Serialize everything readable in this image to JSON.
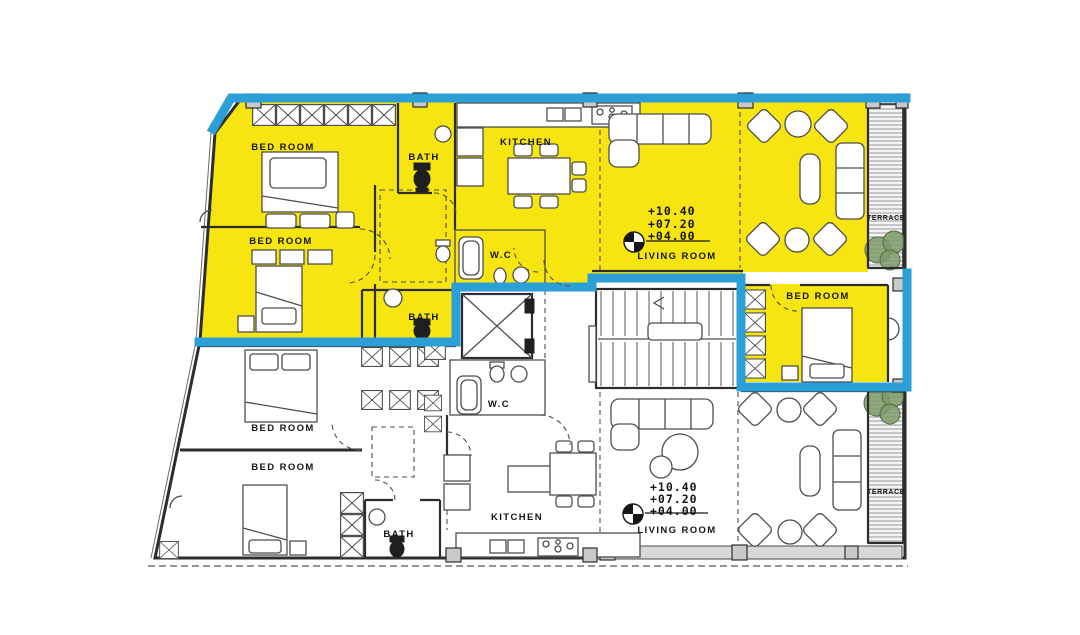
{
  "colors": {
    "highlight": "#F7E511",
    "outline": "#2B9FD6",
    "wall": "#2D2D2D",
    "line": "#4E4E4E",
    "plant": "#7D9A68",
    "hatch": "#8C8C8C",
    "slab": "#D8D8D8",
    "column": "#C9C9C9"
  },
  "upper_unit": {
    "rooms": {
      "bedroom_1": "BED ROOM",
      "bedroom_2": "BED ROOM",
      "bedroom_3": "BED ROOM",
      "bath_1": "BATH",
      "bath_2": "BATH",
      "wc": "W.C",
      "kitchen": "KITCHEN",
      "living_room": "LIVING ROOM",
      "terrace": "TERRACE"
    },
    "levels": [
      "+10.40",
      "+07.20",
      "+04.00"
    ]
  },
  "lower_unit": {
    "rooms": {
      "bedroom_1": "BED ROOM",
      "bedroom_2": "BED ROOM",
      "bath": "BATH",
      "wc": "W.C",
      "kitchen": "KITCHEN",
      "living_room": "LIVING ROOM",
      "terrace": "TERRACE"
    },
    "levels": [
      "+10.40",
      "+07.20",
      "+04.00"
    ]
  }
}
